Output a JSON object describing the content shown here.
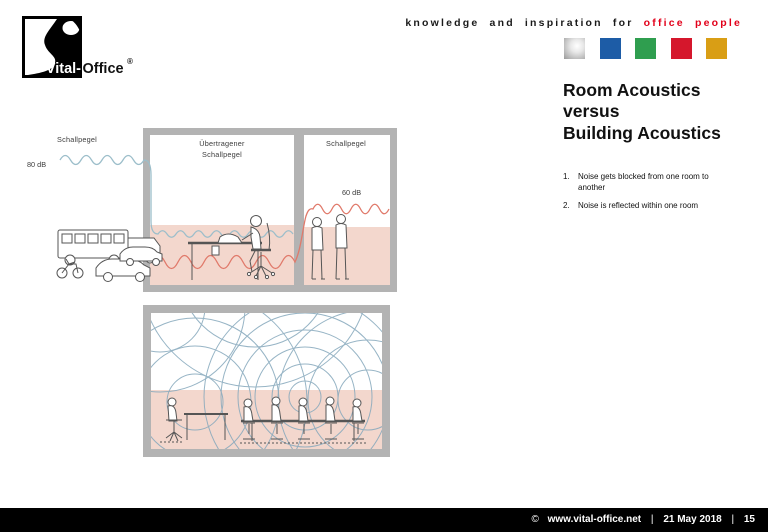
{
  "header": {
    "tagline_black": "knowledge and inspiration for",
    "tagline_red": "office people"
  },
  "logo": {
    "vital": "Vital-",
    "office": "Office",
    "registered": "®"
  },
  "brand_squares": [
    {
      "name": "silver",
      "color": "#b9b9b9"
    },
    {
      "name": "blue",
      "color": "#1d5ca6"
    },
    {
      "name": "green",
      "color": "#2f9e4f"
    },
    {
      "name": "red",
      "color": "#d5172c"
    },
    {
      "name": "gold",
      "color": "#d99e15"
    }
  ],
  "content": {
    "title_lines": [
      "Room Acoustics",
      "versus",
      "Building Acoustics"
    ],
    "list": [
      {
        "num": "1.",
        "text": "Noise gets blocked from one room to another"
      },
      {
        "num": "2.",
        "text": "Noise is reflected within one room"
      }
    ]
  },
  "diagram_top": {
    "outside_wave_label": "Schallpegel",
    "outside_level": "80 dB",
    "room1_label_line1": "Übertragener",
    "room1_label_line2": "Schallpegel",
    "room2_label": "Schallpegel",
    "room2_level": "60 dB"
  },
  "footer": {
    "copyright": "©",
    "url": "www.vital-office.net",
    "separator": "|",
    "date": "21 May 2018",
    "page": "15"
  },
  "colors": {
    "accent_red": "#e2001a",
    "wall_gray": "#b3b3b3",
    "floor_pink": "#f3d7cd",
    "wave_blue": "#9cbeca",
    "wave_red": "#e0796a",
    "figure_line": "#555555",
    "arc_blue": "#85a8bc"
  }
}
